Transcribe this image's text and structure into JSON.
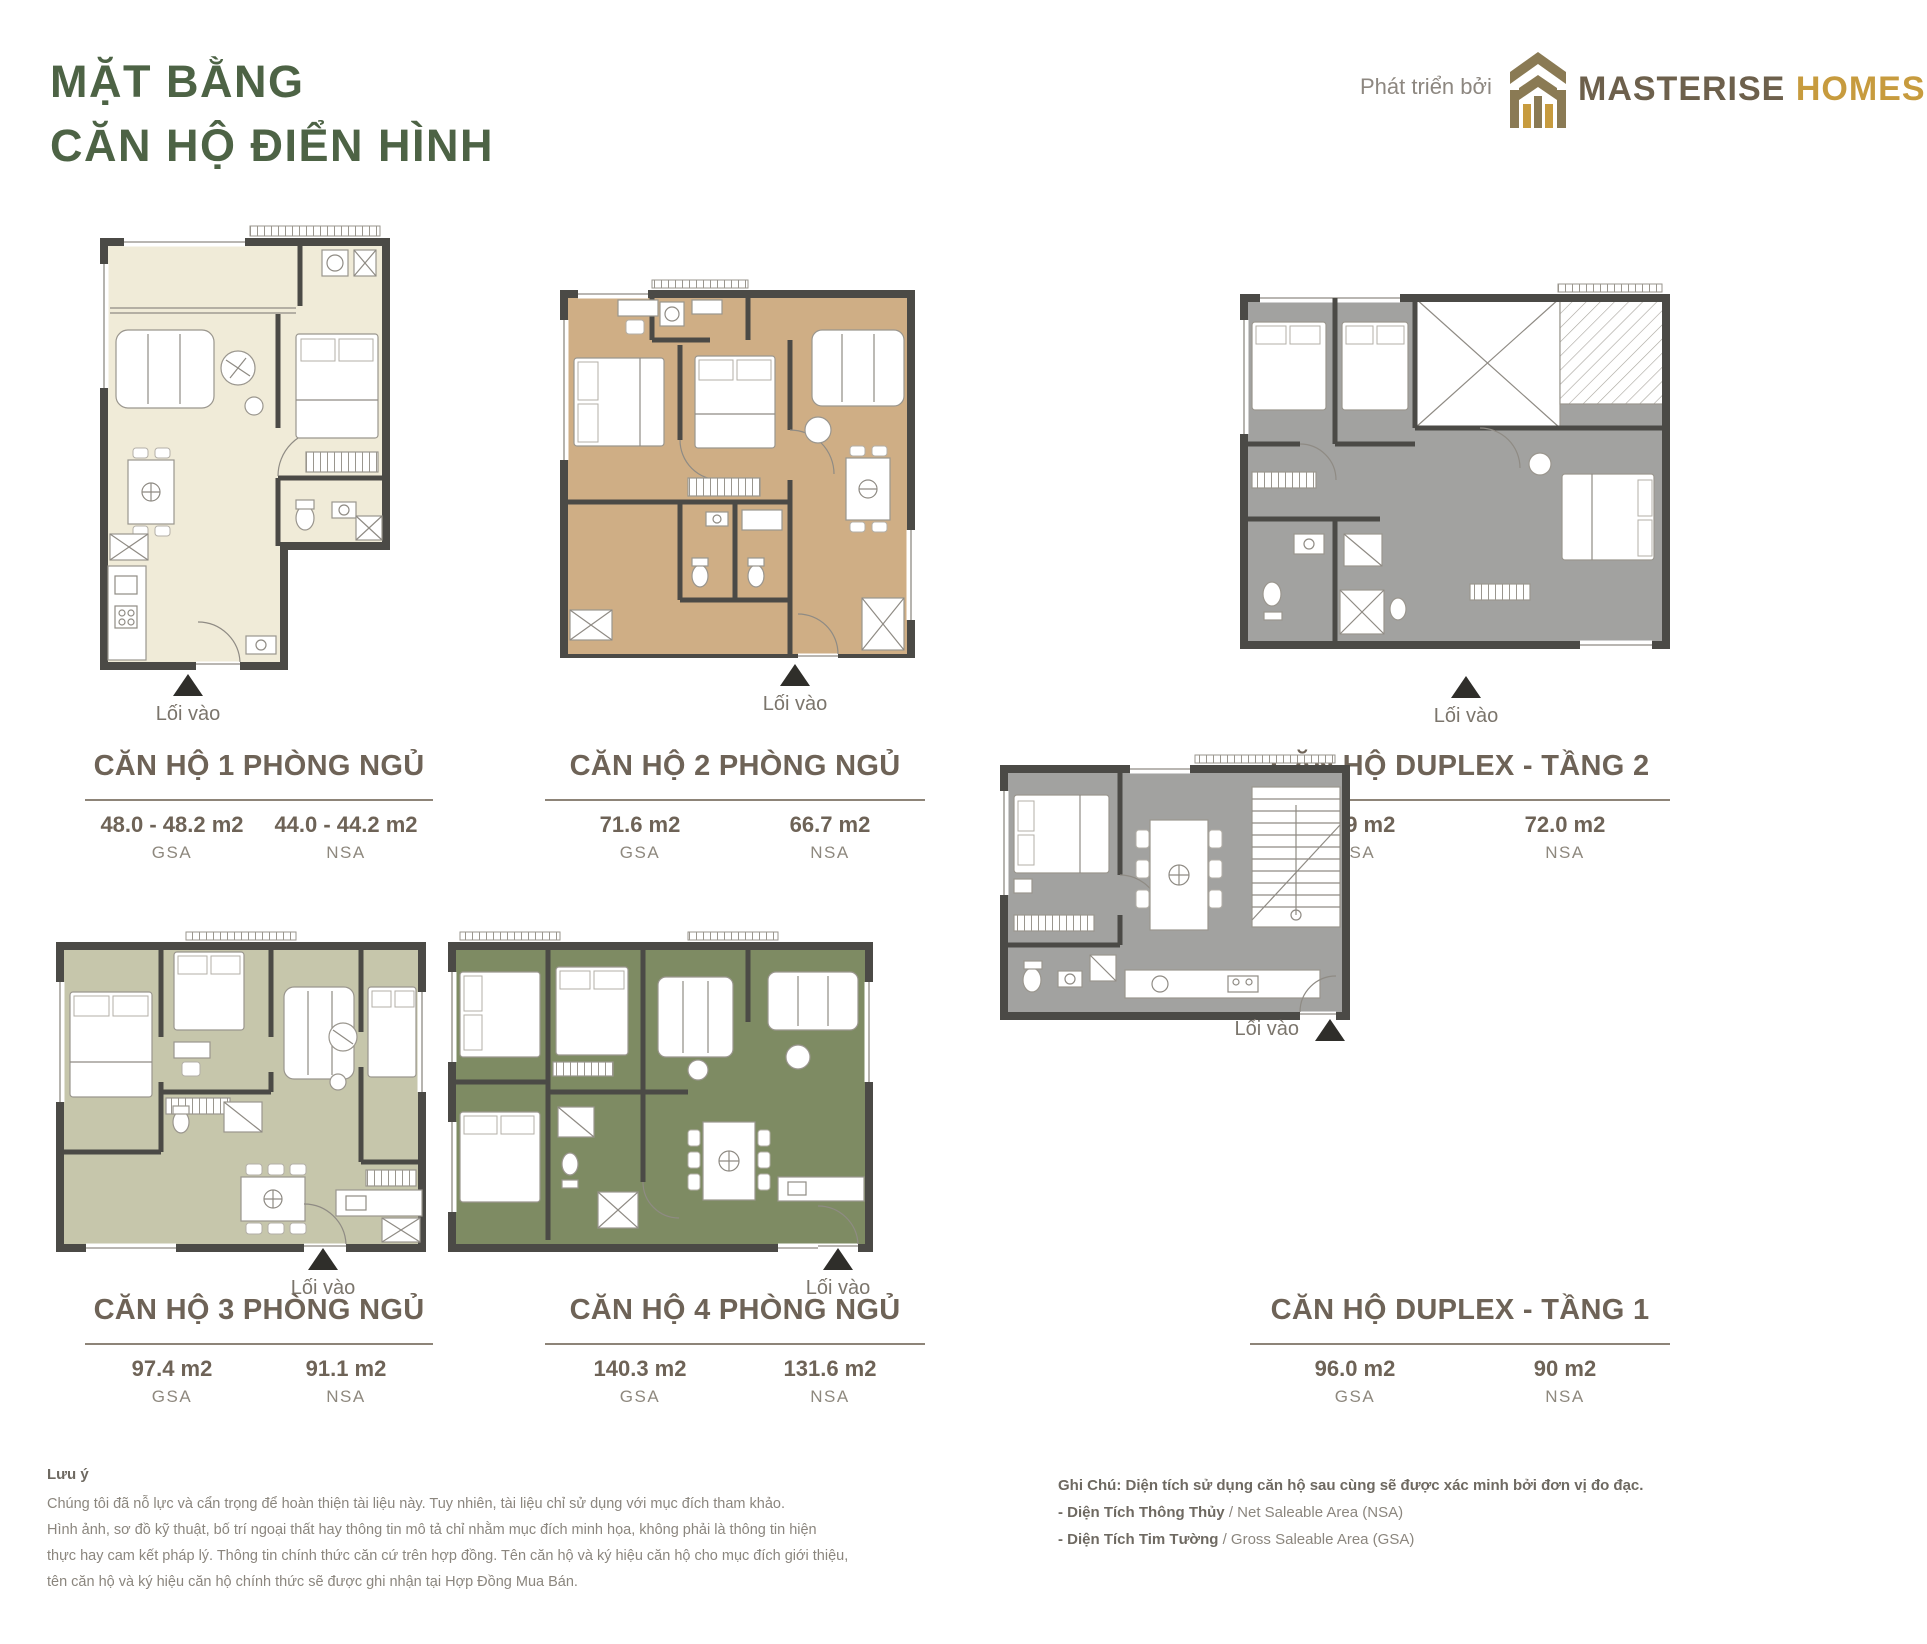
{
  "header": {
    "title": "MẶT BẰNG\nCĂN HỘ ĐIỂN HÌNH",
    "developer_label": "Phát triển bởi",
    "brand_primary": "MASTERISE",
    "brand_secondary": "HOMES"
  },
  "entry_label": "Lối vào",
  "plans": [
    {
      "title": "CĂN HỘ 1 PHÒNG NGỦ",
      "gsa": "48.0 - 48.2 m2",
      "gsa_label": "GSA",
      "nsa": "44.0 - 44.2 m2",
      "nsa_label": "NSA",
      "floor_color": "#f0ebd8"
    },
    {
      "title": "CĂN HỘ 2 PHÒNG NGỦ",
      "gsa": "71.6 m2",
      "gsa_label": "GSA",
      "nsa": "66.7 m2",
      "nsa_label": "NSA",
      "floor_color": "#cfae85"
    },
    {
      "title": "CĂN HỘ DUPLEX - TẦNG 2",
      "gsa": "76.9 m2",
      "gsa_label": "GSA",
      "nsa": "72.0 m2",
      "nsa_label": "NSA",
      "floor_color": "#a2a2a0"
    },
    {
      "title": "CĂN HỘ 3 PHÒNG NGỦ",
      "gsa": "97.4 m2",
      "gsa_label": "GSA",
      "nsa": "91.1 m2",
      "nsa_label": "NSA",
      "floor_color": "#c6c6ab"
    },
    {
      "title": "CĂN HỘ 4 PHÒNG NGỦ",
      "gsa": "140.3 m2",
      "gsa_label": "GSA",
      "nsa": "131.6 m2",
      "nsa_label": "NSA",
      "floor_color": "#7e8b63"
    },
    {
      "title": "CĂN HỘ DUPLEX - TẦNG 1",
      "gsa": "96.0 m2",
      "gsa_label": "GSA",
      "nsa": "90 m2",
      "nsa_label": "NSA",
      "floor_color": "#a2a2a0"
    }
  ],
  "notes_left": {
    "heading": "Lưu ý",
    "line1": "Chúng tôi đã nỗ lực và cẩn trọng để hoàn thiện tài liệu này. Tuy nhiên, tài liệu chỉ sử dụng với mục đích tham khảo.",
    "line2": "Hình ảnh, sơ đồ kỹ thuật, bố trí ngoại thất hay thông tin mô tả chỉ nhằm mục đích minh họa, không phải là thông tin hiện",
    "line3": "thực hay cam kết pháp lý. Thông tin chính thức căn cứ trên hợp đồng. Tên căn hộ và ký hiệu căn hộ cho mục đích giới thiệu,",
    "line4": "tên căn hộ và ký hiệu căn hộ chính thức sẽ được ghi nhận tại Hợp Đồng Mua Bán."
  },
  "notes_right": {
    "heading_line": "Ghi Chú: Diện tích sử dụng căn hộ sau cùng sẽ được xác minh bởi đơn vị đo đạc.",
    "item1_bold": "- Diện Tích Thông Thủy",
    "item1_rest": " / Net Saleable Area (NSA)",
    "item2_bold": "- Diện Tích Tim Tường",
    "item2_rest": " / Gross Saleable Area (GSA)"
  },
  "colors": {
    "title_green": "#4d6345",
    "heading_brown": "#6e6357",
    "wall": "#4b4a46",
    "brand_bronze": "#8a7a54",
    "brand_gold": "#c79b3e",
    "entry_triangle": "#2f2e2a"
  }
}
